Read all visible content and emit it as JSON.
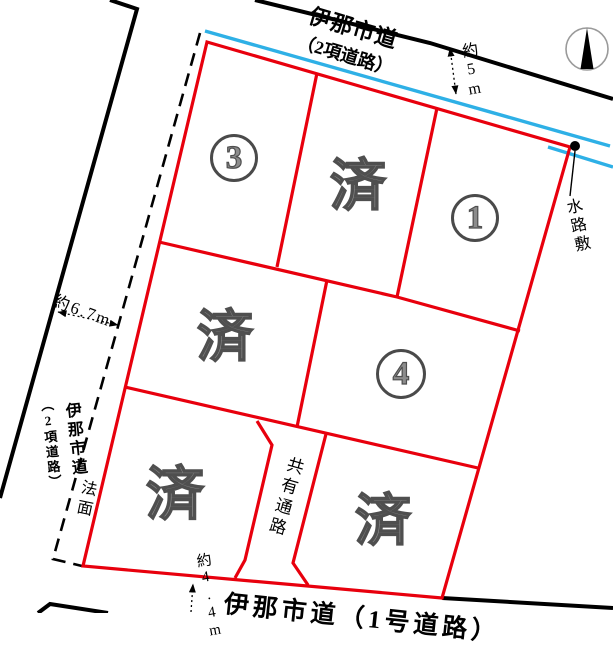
{
  "plan": {
    "roads": {
      "top": {
        "name": "伊那市道",
        "type": "（2項道路）",
        "width": "約5m"
      },
      "left": {
        "name": "伊那市道",
        "type": "（2項道路）",
        "width": "約6.7m"
      },
      "bottom": {
        "name": "伊那市道（1号道路）",
        "width": "約4.4m"
      }
    },
    "lots": [
      {
        "id": "lot-3",
        "number": "3"
      },
      {
        "id": "lot-sold-top",
        "status": "済"
      },
      {
        "id": "lot-1",
        "number": "1"
      },
      {
        "id": "lot-sold-middle",
        "status": "済"
      },
      {
        "id": "lot-4",
        "number": "4"
      },
      {
        "id": "lot-sold-bottom-left",
        "status": "済"
      },
      {
        "id": "lot-sold-bottom-right",
        "status": "済"
      }
    ],
    "annotations": {
      "waterway": "水路敷",
      "slope": "法面",
      "shared_passage": "共有通路"
    },
    "colors": {
      "lot_boundary": "#e8000d",
      "waterway": "#2eb0e6",
      "road": "#000000",
      "gray_text": "#8c8c8c"
    }
  }
}
